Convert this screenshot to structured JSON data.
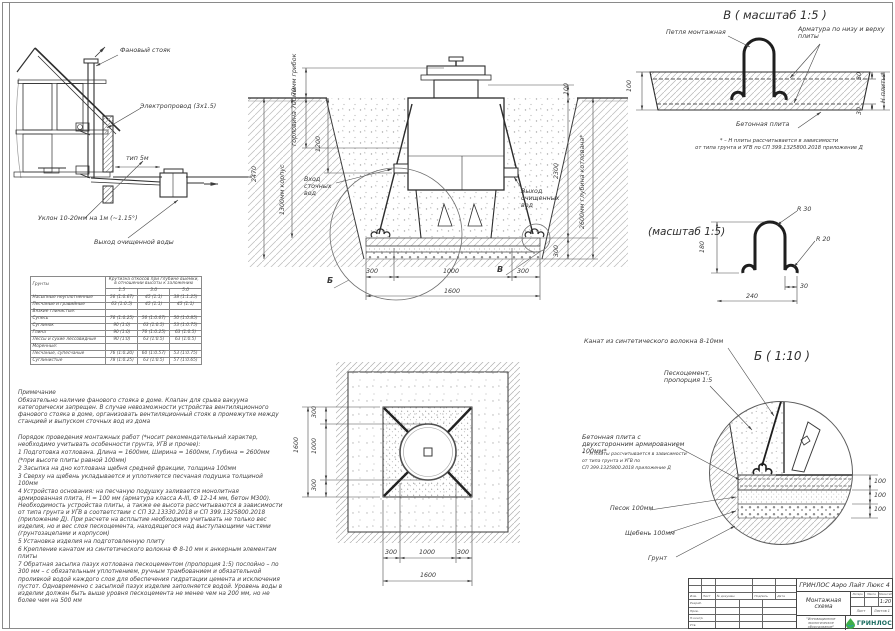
{
  "house": {
    "stack_label": "Фановый стояк",
    "cable_label": "Электропровод (3х1.5)",
    "distance_label": "тип 5м",
    "slope_label": "Уклон 10-20мм на 1м (~1.15°)",
    "outflow_label": "Выход очищенной воды"
  },
  "section": {
    "cap_label": "70мм грибок",
    "neck_label": "горловина 700мм",
    "neck_dim": "1200",
    "left_total_dim": "2470",
    "body_label": "1300мм корпус",
    "inlet_label": "Вход сточных вод",
    "outlet_label": "Выход очищенных вод",
    "top_right_dim": "100",
    "right_dim": "2300",
    "base_dim": "300",
    "depth_label": "2600мм глубина котлована*",
    "bottom_dims": [
      "300",
      "1000",
      "300"
    ],
    "bottom_total": "1600",
    "callout_b": "Б",
    "callout_v": "В"
  },
  "detail_v": {
    "title": "В ( масштаб 1:5 )",
    "loop_label": "Петля монтажная",
    "rebar_label": "Арматура по низу и верху плиты",
    "plate_label": "Бетонная плита",
    "thickness_dim": "100",
    "top_cover_dim": "30",
    "bottom_cover_dim": "30",
    "h_label": "Н плиты*",
    "note_line1": "* – Н плиты рассчитывается в зависимости",
    "note_line2": "от типа грунта и УГВ по СП 399.1325800.2018 приложение Д"
  },
  "loop_detail": {
    "title": "(масштаб 1:5)",
    "radius_top": "R 30",
    "radius_foot": "R 20",
    "height_dim": "180",
    "foot_dim": "30",
    "width_dim": "240"
  },
  "detail_b": {
    "title": "Б ( 1:10 )",
    "rope_label": "Канат из синтетического волокна 8-10мм",
    "sandcement_label": "Пескоцемент, пропорция 1:5",
    "plate_label": "Бетонная плита с двухсторонним армированием 100мм*",
    "note_line1": "* – Н плиты рассчитывается в зависимости",
    "note_line2": "от типа грунта и УГВ по",
    "note_line3": "СП 399.1325800.2018 приложение Д",
    "sand_label": "Песок 100мм",
    "gravel_label": "Щебень 100мм",
    "soil_label": "Грунт",
    "layer_dims": [
      "100",
      "100",
      "100"
    ]
  },
  "plan": {
    "left_total": "1600",
    "left_dims": [
      "300",
      "1000",
      "300"
    ],
    "bottom_dims": [
      "300",
      "1000",
      "300"
    ],
    "bottom_total": "1600"
  },
  "soils_table": {
    "col_soil": "Грунты",
    "col_slope": "Крутизна откосов при глубине выемки, в отношении высоты к заложению",
    "depths": [
      "1.5",
      "3.0",
      "5.0"
    ],
    "rows": [
      {
        "name": "Насыпные неуплотненные",
        "v1": "56 (1:0.67)",
        "v2": "45 (1:1)",
        "v3": "38 (1:1.25)"
      },
      {
        "name": "Песчаные и гравийные",
        "v1": "63 (1:0.5)",
        "v2": "45 (1:1)",
        "v3": "45 (1:1)"
      },
      {
        "name": "Вязкие глинистые:",
        "v1": "",
        "v2": "",
        "v3": ""
      },
      {
        "name": "Супесь",
        "v1": "76 (1:0.25)",
        "v2": "56 (1:0.67)",
        "v3": "50 (1:0.85)"
      },
      {
        "name": "Суглинок",
        "v1": "90 (1:0)",
        "v2": "63 (1:0.5)",
        "v3": "53 (1:0.75)"
      },
      {
        "name": "Глина",
        "v1": "90 (1:0)",
        "v2": "76 (1:0.25)",
        "v3": "63 (1:0.5)"
      },
      {
        "name": "Лессы и сухие лессовидные",
        "v1": "90 (1:0)",
        "v2": "63 (1:0.5)",
        "v3": "63 (1:0.5)"
      },
      {
        "name": "Моренные:",
        "v1": "",
        "v2": "",
        "v3": ""
      },
      {
        "name": "Песчаные, супесчаные",
        "v1": "76 (1:0.20)",
        "v2": "60 (1:0.57)",
        "v3": "53 (1:0.75)"
      },
      {
        "name": "Суглинистые",
        "v1": "78 (1:0.25)",
        "v2": "63 (1:0.5)",
        "v3": "57 (1:0.65)"
      }
    ]
  },
  "notes": {
    "heading": "Примечание",
    "body": "Обязательно наличие фанового стояка в доме. Клапан для срыва вакуума категорически запрещен. В случае невозможности устройства вентиляционного фанового стояка в доме, организовать вентиляционный стояк в промежутке между станцией и выпуском сточных вод из дома",
    "order_heading": "Порядок проведения монтажных работ (*носит рекомендательный характер, необходимо учитывать особенности грунта, УГВ и прочее):",
    "steps": [
      "1 Подготовка котлована. Длина = 1600мм,  Ширина = 1600мм, Глубина = 2600мм (*при высоте плиты равной 100мм)",
      "2 Засыпка на дно котлована щебня средней фракции, толщина 100мм",
      "3 Сверху на щебень укладывается и уплотняется песчаная подушка толщиной 100мм",
      "4 Устройство основания: на песчаную подушку заливается монолитная армированная плита, Н = 100 мм (арматура класса А-III, Ф 12-14 мм, бетон М300). Необходимость устройства плиты, а также ее высота рассчитываются в зависимости от типа грунта и УГВ в соответствии с СП 32.13330.2018 и СП 399.1325800.2018 (приложение Д). При расчете на всплытие необходимо учитывать не только вес изделия, но и вес слоя пескоцемента, находящегося над выступающими частями (грунтозацепами и корпусом)",
      "5 Установка изделия на подготовленную плиту",
      "6 Крепление канатом из синтетического волокна Ф 8-10 мм к анкерным элементам плиты",
      "7 Обратная засыпка пазух котлована пескоцементом (пропорция 1:5) послойно – по 300 мм – с обязательным уплотнением, ручным трамбованием и обязательной проливкой водой каждого слоя для обеспечения гидратации цемента и исключения пустот. Одновременно с засыпкой пазух изделие заполняется водой. Уровень воды в изделии должен быть выше уровня пескоцемента не менее чем на 200 мм, но не более чем на 500 мм"
    ]
  },
  "titleblock": {
    "doc_name": "ГРИНЛОС Аэро Лайт Люкс 4",
    "sheet_name": "Монтажная схема",
    "col_litera": "Литера",
    "col_mass": "Масса",
    "col_scale": "Масштаб",
    "scale": "1:20",
    "sheet_label": "Лист",
    "sheets_label": "Листов 1",
    "tagline": "\"Инновационное экологическое оборудование\"",
    "logo_text": "ГРИНЛОС",
    "header_cols": [
      "Изм.",
      "Лист",
      "№ докумен.",
      "Подпись",
      "Дата"
    ],
    "staff_rows": [
      "Разраб.",
      "Пров.",
      "Н.контр.",
      "Утв."
    ]
  }
}
